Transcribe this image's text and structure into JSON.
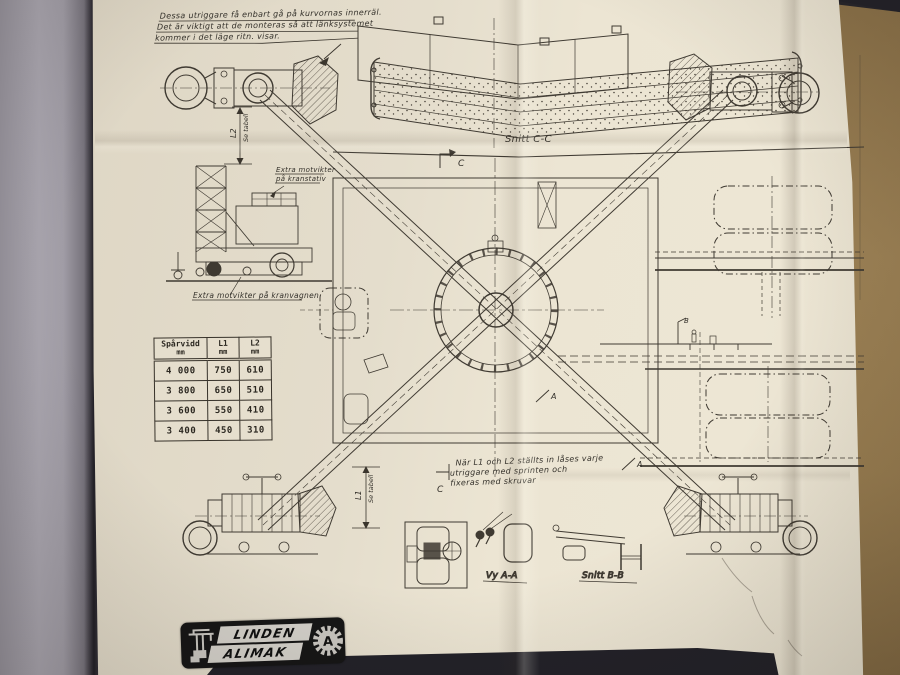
{
  "notes": {
    "top": [
      "Dessa utriggare få enbart gå på kurvornas innerräl.",
      "Det är viktigt att de monteras så att länksystemet",
      "kommer i det läge ritn. visar."
    ],
    "mid": [
      "När L1 och L2 ställts in låses varje",
      "utriggare med sprinten och",
      "fixeras med skruvar"
    ]
  },
  "labels": {
    "snitt_cc": "Snitt C-C",
    "vy_aa": "Vy A-A",
    "snitt_bb": "Snitt B-B",
    "extra_stativ_1": "Extra motvikter",
    "extra_stativ_2": "på kranstativ",
    "extra_vagn": "Extra motvikter på kranvagnen",
    "l1": "L1",
    "l2": "L2",
    "se_tabell": "Se tabell",
    "c": "C",
    "a": "A",
    "b": "B"
  },
  "table": {
    "col0": {
      "name": "Spårvidd",
      "unit": "mm"
    },
    "col1": {
      "name": "L1",
      "unit": "mm"
    },
    "col2": {
      "name": "L2",
      "unit": "mm"
    },
    "rows": [
      [
        "4 000",
        "750",
        "610"
      ],
      [
        "3 800",
        "650",
        "510"
      ],
      [
        "3 600",
        "550",
        "410"
      ],
      [
        "3 400",
        "450",
        "310"
      ]
    ]
  },
  "logo": {
    "line1": "LINDEN",
    "line2": "ALIMAK",
    "gear_letter": "A"
  },
  "colors": {
    "paper": "#e4ddcc",
    "ink": "#3f3a32",
    "table_surface": "#96794d",
    "binder_pages": "#a39fa8",
    "logo_bg": "#161616"
  }
}
